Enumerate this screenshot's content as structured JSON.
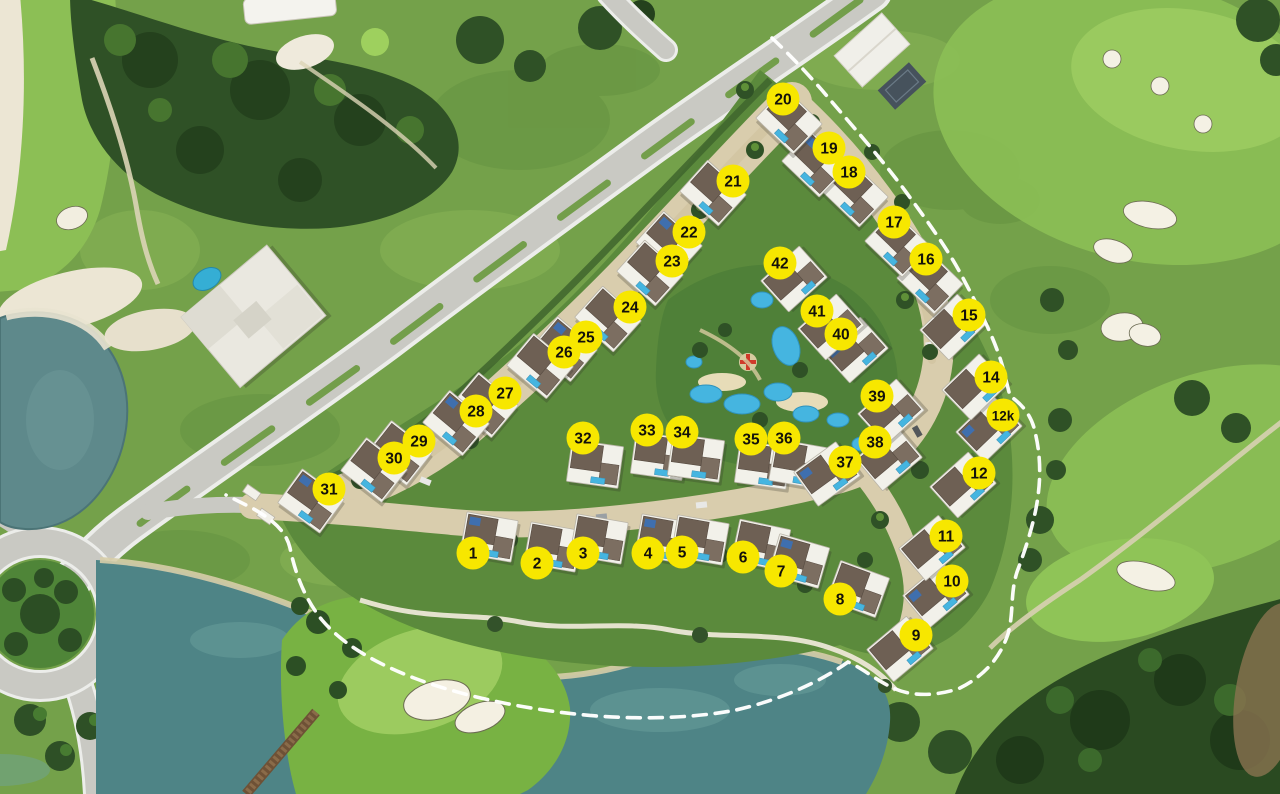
{
  "site_plan": {
    "type": "aerial-master-plan",
    "colors": {
      "marker_fill": "#F7E700",
      "marker_text": "#14120A",
      "boundary_line": "#FFFFFF",
      "lake_water": "#5E898B",
      "pool_water": "#45B5E0",
      "road_asphalt": "#C9C9C3",
      "road_paver": "#D9CDAD",
      "grass_base": "#74A14A",
      "fairway_green": "#8CBF55",
      "tree_dark": "#2F5126",
      "sand": "#F2EEE0",
      "house_body": "#F2F1EA",
      "house_roof": "#6E6054",
      "house_roof_2": "#7C6E61",
      "house_shadow": "#2C2C24"
    },
    "lots": [
      {
        "id": "1",
        "x": 473,
        "y": 553,
        "house": {
          "dx": 16,
          "dy": -16,
          "rot": 10
        }
      },
      {
        "id": "2",
        "x": 537,
        "y": 563,
        "house": {
          "dx": 16,
          "dy": -16,
          "rot": 10
        }
      },
      {
        "id": "3",
        "x": 583,
        "y": 553,
        "house": {
          "dx": 16,
          "dy": -14,
          "rot": 10
        }
      },
      {
        "id": "4",
        "x": 648,
        "y": 553,
        "house": {
          "dx": 16,
          "dy": -14,
          "rot": 10
        }
      },
      {
        "id": "5",
        "x": 682,
        "y": 552,
        "house": {
          "dx": 18,
          "dy": -12,
          "rot": 10
        }
      },
      {
        "id": "6",
        "x": 743,
        "y": 557,
        "house": {
          "dx": 18,
          "dy": -12,
          "rot": 12
        }
      },
      {
        "id": "7",
        "x": 781,
        "y": 571,
        "house": {
          "dx": 18,
          "dy": -10,
          "rot": 16
        }
      },
      {
        "id": "8",
        "x": 840,
        "y": 599,
        "house": {
          "dx": 18,
          "dy": -10,
          "rot": 20
        }
      },
      {
        "id": "9",
        "x": 916,
        "y": 635,
        "house": {
          "dx": -16,
          "dy": 14,
          "rot": -40
        }
      },
      {
        "id": "10",
        "x": 952,
        "y": 581,
        "house": {
          "dx": -16,
          "dy": 14,
          "rot": -40
        }
      },
      {
        "id": "11",
        "x": 946,
        "y": 536,
        "house": {
          "dx": -14,
          "dy": 12,
          "rot": -40
        }
      },
      {
        "id": "12",
        "x": 979,
        "y": 473,
        "house": {
          "dx": -16,
          "dy": 12,
          "rot": -42
        }
      },
      {
        "id": "12k",
        "x": 1003,
        "y": 415,
        "house": {
          "dx": -14,
          "dy": 14,
          "rot": -44
        }
      },
      {
        "id": "14",
        "x": 991,
        "y": 377,
        "house": {
          "dx": -16,
          "dy": 10,
          "rot": -44
        }
      },
      {
        "id": "15",
        "x": 969,
        "y": 315,
        "house": {
          "dx": -16,
          "dy": 12,
          "rot": -44
        }
      },
      {
        "id": "16",
        "x": 926,
        "y": 259,
        "house": {
          "dx": 4,
          "dy": 22,
          "rot": 44
        }
      },
      {
        "id": "17",
        "x": 894,
        "y": 222,
        "house": {
          "dx": 4,
          "dy": 22,
          "rot": 44
        }
      },
      {
        "id": "18",
        "x": 849,
        "y": 172,
        "house": {
          "dx": 6,
          "dy": 22,
          "rot": 44
        }
      },
      {
        "id": "19",
        "x": 829,
        "y": 148,
        "house": {
          "dx": -14,
          "dy": 16,
          "rot": 44
        }
      },
      {
        "id": "20",
        "x": 783,
        "y": 99,
        "house": {
          "dx": 6,
          "dy": 22,
          "rot": 44
        }
      },
      {
        "id": "21",
        "x": 733,
        "y": 181,
        "house": {
          "dx": -20,
          "dy": 12,
          "rot": 42
        }
      },
      {
        "id": "22",
        "x": 689,
        "y": 232,
        "house": {
          "dx": -20,
          "dy": 12,
          "rot": 42
        }
      },
      {
        "id": "23",
        "x": 672,
        "y": 261,
        "house": {
          "dx": -22,
          "dy": 12,
          "rot": 42
        }
      },
      {
        "id": "24",
        "x": 630,
        "y": 307,
        "house": {
          "dx": -22,
          "dy": 12,
          "rot": 42
        }
      },
      {
        "id": "25",
        "x": 586,
        "y": 337,
        "house": {
          "dx": -22,
          "dy": 12,
          "rot": 40
        }
      },
      {
        "id": "26",
        "x": 564,
        "y": 352,
        "house": {
          "dx": -24,
          "dy": 14,
          "rot": 40
        }
      },
      {
        "id": "27",
        "x": 505,
        "y": 393,
        "house": {
          "dx": -20,
          "dy": 12,
          "rot": 40
        }
      },
      {
        "id": "28",
        "x": 476,
        "y": 411,
        "house": {
          "dx": -20,
          "dy": 12,
          "rot": 40
        }
      },
      {
        "id": "29",
        "x": 419,
        "y": 441,
        "house": {
          "dx": -20,
          "dy": 12,
          "rot": 38
        }
      },
      {
        "id": "30",
        "x": 394,
        "y": 458,
        "house": {
          "dx": -20,
          "dy": 12,
          "rot": 38
        }
      },
      {
        "id": "31",
        "x": 329,
        "y": 489,
        "house": {
          "dx": -18,
          "dy": 12,
          "rot": 36
        }
      },
      {
        "id": "32",
        "x": 583,
        "y": 438,
        "house": {
          "dx": 12,
          "dy": 26,
          "rot": 8
        }
      },
      {
        "id": "33",
        "x": 647,
        "y": 430,
        "house": {
          "dx": 12,
          "dy": 26,
          "rot": 8
        }
      },
      {
        "id": "34",
        "x": 682,
        "y": 432,
        "house": {
          "dx": 14,
          "dy": 26,
          "rot": 8
        }
      },
      {
        "id": "35",
        "x": 751,
        "y": 439,
        "house": {
          "dx": 12,
          "dy": 26,
          "rot": 8
        }
      },
      {
        "id": "36",
        "x": 784,
        "y": 438,
        "house": {
          "dx": 14,
          "dy": 26,
          "rot": 10
        }
      },
      {
        "id": "37",
        "x": 845,
        "y": 462,
        "house": {
          "dx": -18,
          "dy": 12,
          "rot": -36
        }
      },
      {
        "id": "38",
        "x": 875,
        "y": 442,
        "house": {
          "dx": 14,
          "dy": 16,
          "rot": -40
        }
      },
      {
        "id": "39",
        "x": 877,
        "y": 396,
        "house": {
          "dx": 14,
          "dy": 16,
          "rot": -42
        }
      },
      {
        "id": "40",
        "x": 841,
        "y": 334,
        "house": {
          "dx": 14,
          "dy": 16,
          "rot": -42
        }
      },
      {
        "id": "41",
        "x": 817,
        "y": 311,
        "house": {
          "dx": 14,
          "dy": 16,
          "rot": -42
        }
      },
      {
        "id": "42",
        "x": 780,
        "y": 263,
        "house": {
          "dx": 14,
          "dy": 16,
          "rot": -42
        }
      }
    ]
  }
}
